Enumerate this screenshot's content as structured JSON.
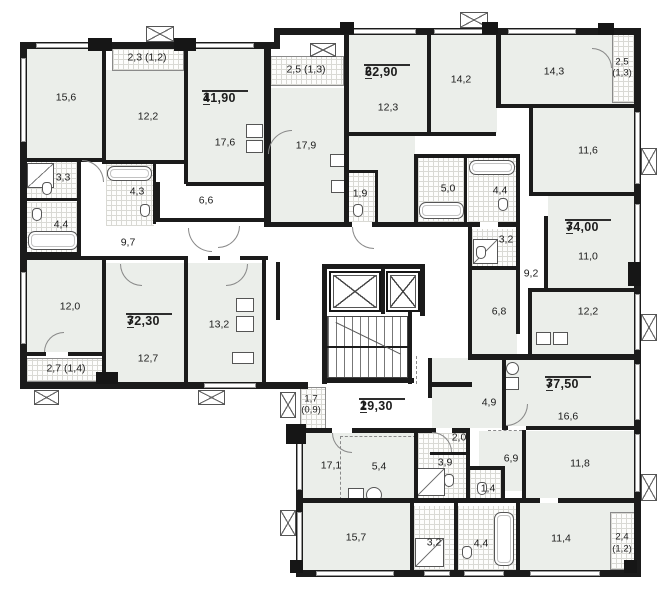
{
  "apartments": [
    {
      "rooms": "1",
      "area": "41,90"
    },
    {
      "rooms": "2",
      "area": "62,90"
    },
    {
      "rooms": "3",
      "area": "74,00"
    },
    {
      "rooms": "3",
      "area": "72,30"
    },
    {
      "rooms": "1",
      "area": "29,30"
    },
    {
      "rooms": "3",
      "area": "77,50"
    }
  ],
  "rooms": {
    "r15_6": "15,6",
    "r12_2": "12,2",
    "r17_6": "17,6",
    "r17_9": "17,9",
    "r12_3": "12,3",
    "r14_2": "14,2",
    "r14_3": "14,3",
    "r11_6": "11,6",
    "r10_3": "10,3",
    "r3_3": "3,3",
    "r4_3": "4,3",
    "r6_6": "6,6",
    "r1_9": "1,9",
    "r5_0": "5,0",
    "r4_4a": "4,4",
    "r4_4b": "4,4",
    "r9_7": "9,7",
    "r3_2a": "3,2",
    "r9_2": "9,2",
    "r11_0": "11,0",
    "r12_0": "12,0",
    "r6_8": "6,8",
    "r12_2b": "12,2",
    "r13_2": "13,2",
    "r12_7": "12,7",
    "r4_9": "4,9",
    "r16_6": "16,6",
    "r2_0": "2,0",
    "r17_1": "17,1",
    "r5_4": "5,4",
    "r3_9": "3,9",
    "r6_9": "6,9",
    "r11_8": "11,8",
    "r1_4": "1,4",
    "r15_7": "15,7",
    "r3_2b": "3,2",
    "r4_4c": "4,4",
    "r11_4": "11,4"
  },
  "balconies": {
    "b2_3": "2,3 (1,2)",
    "b2_5a": "2,5 (1,3)",
    "b2_5b_1": "2,5",
    "b2_5b_2": "(1,3)",
    "b2_7": "2,7 (1,4)",
    "b1_7_1": "1,7",
    "b1_7_2": "(0,9)",
    "b2_4_1": "2,4",
    "b2_4_2": "(1,2)"
  }
}
